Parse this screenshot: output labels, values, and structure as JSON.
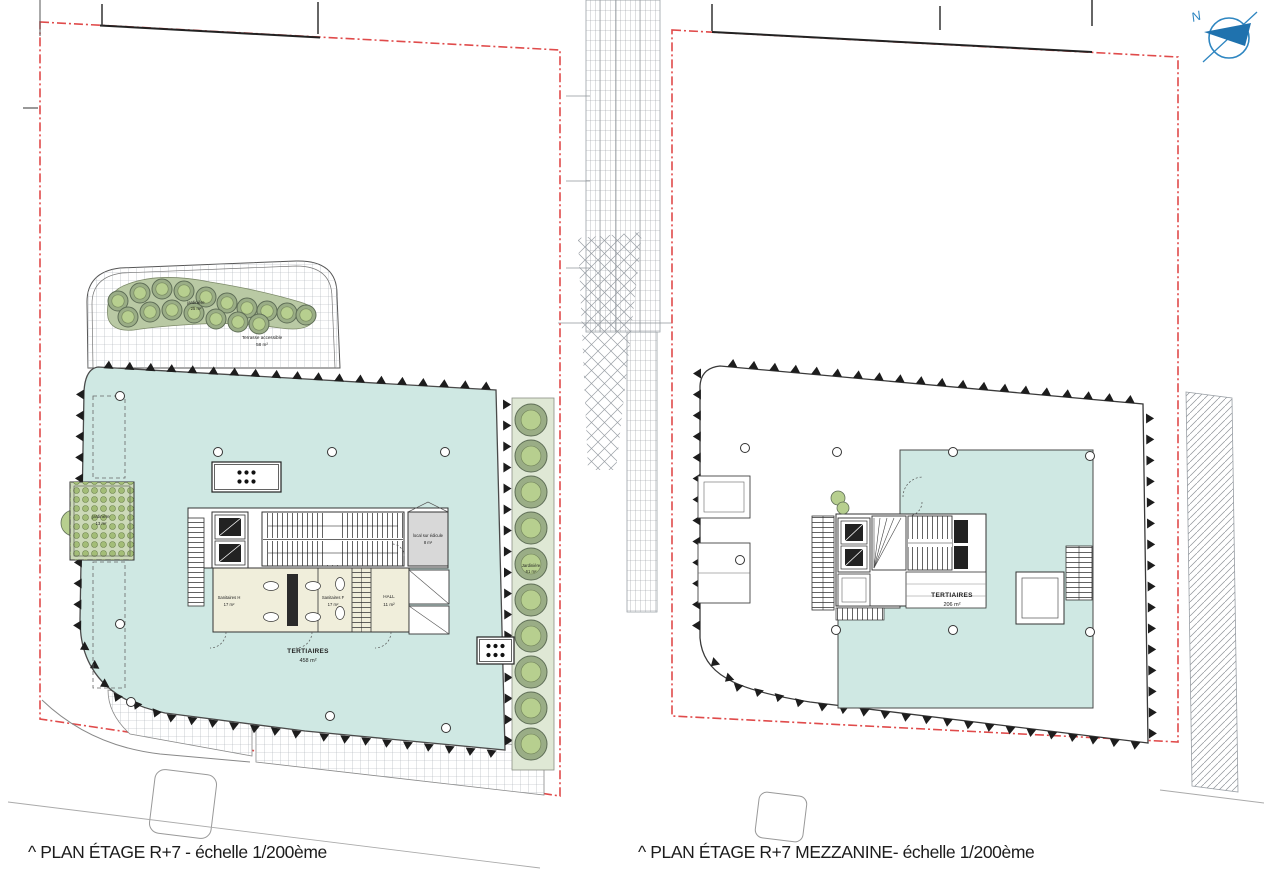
{
  "document": {
    "kind": "architectural floor plan sheet",
    "sheet_scale": "1/200ème"
  },
  "captions": {
    "left": "^ PLAN ÉTAGE R+7 - échelle 1/200ème",
    "right": "^ PLAN ÉTAGE R+7 MEZZANINE- échelle 1/200ème"
  },
  "plans": {
    "left": {
      "name": "PLAN ÉTAGE R+7",
      "scale": "1/200ème",
      "labels": {
        "tertiaires": {
          "name": "TERTIAIRES",
          "area": "458 m²"
        },
        "hall": {
          "name": "HALL",
          "area": "11 m²"
        },
        "sanitaires_h": {
          "name": "Sanitaires H",
          "area": "17 m²"
        },
        "sanitaires_f": {
          "name": "Sanitaires F",
          "area": "17 m²"
        },
        "edicule": {
          "name": "local sur édicule",
          "area": "8 m²"
        },
        "jardiniere_terrasse": {
          "name": "jardinière",
          "area": "25 m²"
        },
        "terrasse": {
          "name": "Terrasse accessible",
          "area": "58 m²"
        },
        "jardiniere_ouest": {
          "name": "jardinière",
          "area": "13 m²"
        },
        "jardiniere_est": {
          "name": "Jardinière",
          "area": "61 m²"
        }
      }
    },
    "right": {
      "name": "PLAN ÉTAGE R+7 MEZZANINE",
      "scale": "1/200ème",
      "labels": {
        "tertiaires": {
          "name": "TERTIAIRES",
          "area": "206 m²"
        }
      }
    }
  },
  "north_arrow": {
    "label": "N"
  },
  "colors": {
    "floor_teal": "#cfe8e3",
    "room_beige": "#f0eedb",
    "edicule_gray": "#d8d8d8",
    "tree_green": "#9aad86",
    "tree_green_light": "#b7cf8f",
    "planter_green": "#ccd9b8",
    "boundary_red": "#e04b4b",
    "hatch_gray": "#9aa0a6",
    "line_dark": "#3a3a3a",
    "north_blue": "#2e86c1"
  }
}
